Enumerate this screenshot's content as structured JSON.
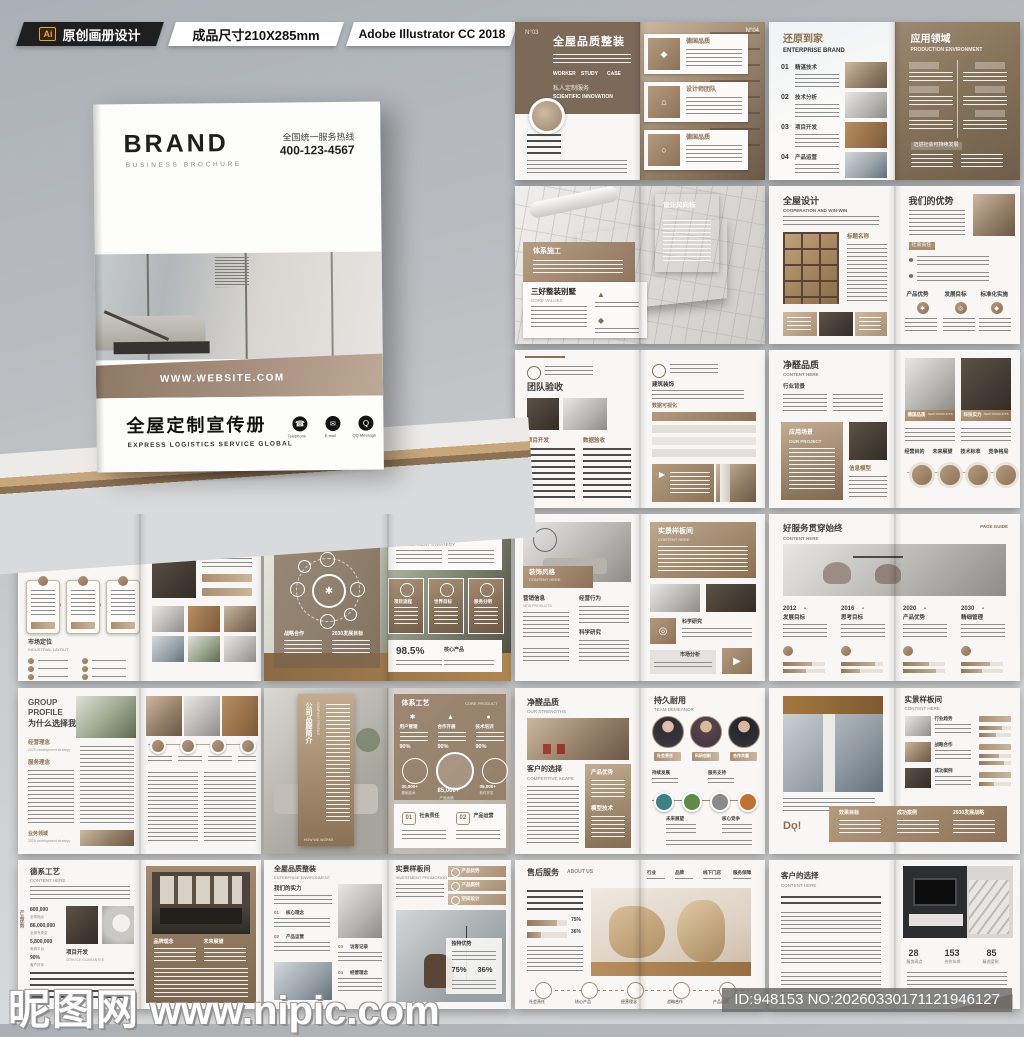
{
  "topbar": {
    "ai_badge": "Ai",
    "label1": "原创画册设计",
    "label2": "成品尺寸210X285mm",
    "label3": "Adobe Illustrator CC 2018"
  },
  "icons": {
    "phone": "☎",
    "mail": "✉",
    "qq": "Q",
    "gear": "✱",
    "target": "◎",
    "send": "▶",
    "tri": "▲",
    "box": "◆",
    "ring": "○",
    "dot": "●",
    "home": "⌂"
  },
  "cover": {
    "brand": "BRAND",
    "brand_sub": "BUSINESS BROCHURE",
    "hotline_label": "全国统一服务热线",
    "hotline": "400-123-4567",
    "website": "WWW.WEBSITE.COM",
    "title": "全屋定制宣传册",
    "subtitle": "EXPRESS LOGISTICS SERVICE GLOBAL",
    "contacts": [
      {
        "label": "Telephone"
      },
      {
        "label": "E-mail"
      },
      {
        "label": "QQ Message"
      }
    ]
  },
  "spreads": {
    "a": {
      "no_left": "N°03",
      "no_right": "N°04",
      "title": "全屋品质整装",
      "tabs": [
        "WORKER",
        "STUDY",
        "CASE"
      ],
      "sub_cn": "私人定制服务",
      "sub_en": "SCIENTIFIC INNOVATION",
      "cards": [
        "德国品质",
        "设计师团队",
        "德国品质"
      ]
    },
    "b": {
      "title": "还原到家",
      "sub": "ENTERPRISE BRAND",
      "items": [
        {
          "no": "01",
          "label": "精湛技术"
        },
        {
          "no": "02",
          "label": "技术分析"
        },
        {
          "no": "03",
          "label": "项目开发"
        },
        {
          "no": "04",
          "label": "产品运营"
        }
      ],
      "right_title": "应用领域",
      "right_sub": "PRODUCTION ENVIRONMENT",
      "footer": "迈进社会可持续发展"
    },
    "c": {
      "tag1": "体系施工",
      "card_title": "三好整装别墅",
      "card_sub": "CORE VALUES",
      "tag2": "设计风向标",
      "tag2_sub": "MESSAGE"
    },
    "d": {
      "title": "全屋设计",
      "sub": "COOPERATION AND WIN-WIN",
      "mid": "标题名称",
      "right_title": "我们的优势",
      "tag": "社会责任",
      "cols": [
        "产品优势",
        "发展目标",
        "标准化实施"
      ]
    },
    "e": {
      "title": "团队验收",
      "col1": "项目开发",
      "col2": "数据验收",
      "r1": "建筑装饰",
      "r2": "数据可视化"
    },
    "f": {
      "title": "净醛品质",
      "sub": "CONTENT HERE",
      "sec1": "行业背景",
      "panel": "应用场景",
      "panel_sub": "OUR PROJECT",
      "sec2": "信息模型",
      "cap1": "德国品质",
      "cap1_en": "NEW PRODUCTS",
      "cap2": "科技实力",
      "cap2_en": "NEW PRODUCTS",
      "steps": [
        "经营目的",
        "未来展望",
        "技术标准",
        "竞争格局"
      ]
    },
    "g": {
      "brand": "BRAND",
      "page": "PAGE 01/02",
      "e1": "INDUSTRIAL",
      "e2": "SERVICES",
      "cn": "高颜值设计",
      "sec": "市场定位",
      "sec_sub": "INDUSTRIAL LAYOUT",
      "right": "工序缔造"
    },
    "h": {
      "t": "陆运集成方案",
      "s": "CONTENT HERE",
      "f1": "战略合作",
      "f2": "2030发展目标",
      "rt": "物流运营维护",
      "rs": "DEVELOPMENT STRATEGY",
      "cards": [
        "项目流程",
        "世界目标",
        "服务分明"
      ],
      "stat": "98.5%",
      "stat_label": "核心产品"
    },
    "i": {
      "band": "装饰风格",
      "band_en": "CONTENT HERE",
      "c1": "营销信息",
      "c1e": "NEW PRODUCTS",
      "c2": "经营行为",
      "c3": "科学研究",
      "rt": "实景样板间",
      "rs": "CONTENT HERE",
      "tag1": "科学研究",
      "tag2": "市场分析"
    },
    "j": {
      "t": "好服务贯穿始终",
      "s": "CONTENT HERE",
      "page": "PAGE GUIDE",
      "cols": [
        {
          "year": "2012",
          "label": "发展目标"
        },
        {
          "year": "2016",
          "label": "思考目标"
        },
        {
          "year": "2020",
          "label": "产品优势"
        },
        {
          "year": "2030",
          "label": "精细管理"
        }
      ]
    },
    "k": {
      "e1": "GROUP",
      "e2": "PROFILE",
      "cn": "为什么选择我们",
      "s1": "经营理念",
      "s1e": "2025 development strategy",
      "s2": "服务理念",
      "s3": "业务领域",
      "s3e": "2025 development strategy"
    },
    "l": {
      "vt": "公司品牌简介",
      "ve": "COMPANY PROFILE",
      "vf": "HOW WE WORKS",
      "rt": "体系工艺",
      "re": "CORE PRODUCT",
      "m": [
        {
          "label": "用户管理",
          "pct": "90%"
        },
        {
          "label": "合作开展",
          "pct": "90%"
        },
        {
          "label": "技术培训",
          "pct": "90%"
        }
      ],
      "c": [
        {
          "num": "30,000+",
          "label": "基础技术"
        },
        {
          "num": "85,000+",
          "label": "产品远销"
        },
        {
          "num": "35,000+",
          "label": "软件开发"
        }
      ],
      "items": [
        {
          "no": "01",
          "label": "社会责任"
        },
        {
          "no": "02",
          "label": "产品运营"
        }
      ]
    },
    "m": {
      "t": "净醛品质",
      "s": "OUR STRENGTHS",
      "sec": "客户的选择",
      "sece": "COMPETITIVE SCAPE",
      "p1": "产品优势",
      "p2": "模型技术",
      "rt": "持久耐用",
      "re": "TEAM DEMEANOR",
      "pills": [
        "社会责任",
        "科研创新",
        "合作共赢"
      ],
      "steps": [
        "持续发展",
        "服务支持",
        "未来展望",
        "核心竞争"
      ]
    },
    "n": {
      "band": [
        "效果目标",
        "成功案例",
        "2030发展战略"
      ],
      "rt": "实景样板间",
      "re": "CONTENT HERE",
      "rows": [
        "行业趋势",
        "战略合作",
        "成功案例"
      ]
    },
    "o": {
      "t": "德系工艺",
      "s": "CONTENT HERE",
      "v": "产品优势",
      "stats": [
        {
          "num": "800,000",
          "label": "全球网点"
        },
        {
          "num": "86,000,000",
          "label": "全球专卖店"
        },
        {
          "num": "5,800,000",
          "label": "电商平台"
        },
        {
          "num": "90%",
          "label": "客户好评"
        }
      ],
      "sec": "项目开发",
      "sece": "SERVICE GUARANTEE",
      "rc": [
        "品牌理念",
        "未来展望"
      ]
    },
    "p": {
      "t": "全屋品质整装",
      "s": "ENTERPRISE ENVIRONMENT",
      "sec": "我们的实力",
      "items": [
        {
          "no": "01",
          "label": "核心理念"
        },
        {
          "no": "02",
          "label": "产品运营"
        },
        {
          "no": "03",
          "label": "访客记录"
        },
        {
          "no": "04",
          "label": "经营理念"
        }
      ],
      "rt": "实景样板间",
      "re": "INVESTMENT PROMOTION",
      "pills": [
        "产品优势",
        "产品案例",
        "空间设计"
      ],
      "card": "独特优势",
      "pcts": [
        "75%",
        "36%"
      ]
    },
    "q": {
      "t": "售后服务",
      "s": "ABOUT US",
      "tabs": [
        "行业",
        "品牌",
        "线下门店",
        "服务保障"
      ],
      "pcts": [
        "75%",
        "36%"
      ],
      "icons_row": [
        "社会责任",
        "核心产品",
        "经营理念",
        "战略合作",
        "产品运营"
      ]
    },
    "r": {
      "t": "客户的选择",
      "s": "CONTENT HERE",
      "stats": [
        {
          "num": "28",
          "label": "服务网点"
        },
        {
          "num": "153",
          "label": "合作伙伴"
        },
        {
          "num": "85",
          "label": "精选案例"
        }
      ]
    }
  },
  "footer": {
    "watermark_cn": "昵图网",
    "watermark_url": "www.nipic.com",
    "id_text": "ID:948153 NO:20260330171121946127"
  }
}
